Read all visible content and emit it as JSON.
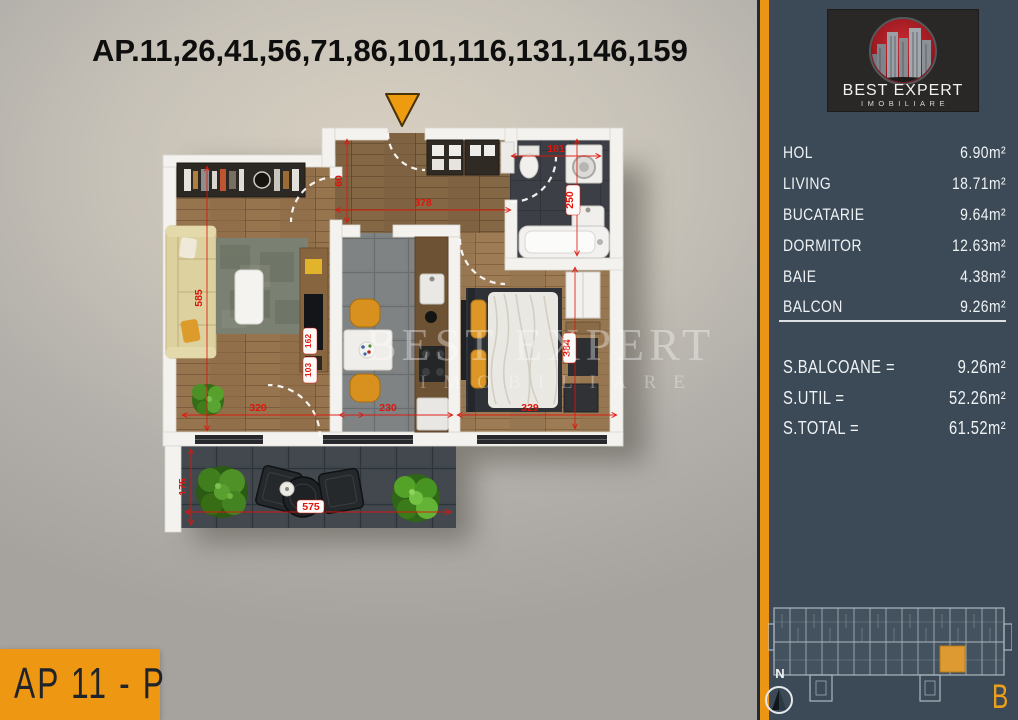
{
  "title": "AP.11,26,41,56,71,86,101,116,131,146,159",
  "apartment": {
    "label": "AP 11 - P"
  },
  "logo": {
    "name": "BEST EXPERT",
    "tagline": "IMOBILIARE"
  },
  "watermark": {
    "line1": "BEST EXPERT",
    "line2": "IMOBILIARE"
  },
  "sidebar": {
    "rooms": [
      {
        "name": "HOL",
        "area": "6.90m²"
      },
      {
        "name": "LIVING",
        "area": "18.71m²"
      },
      {
        "name": "BUCATARIE",
        "area": "9.64m²"
      },
      {
        "name": "DORMITOR",
        "area": "12.63m²"
      },
      {
        "name": "BAIE",
        "area": "4.38m²"
      },
      {
        "name": "BALCON",
        "area": "9.26m²"
      }
    ],
    "totals": [
      {
        "label": "S.BALCOANE =",
        "value": "9.26m²"
      },
      {
        "label": "S.UTIL =",
        "value": "52.26m²"
      },
      {
        "label": "S.TOTAL =",
        "value": "61.52m²"
      }
    ],
    "compass": "N",
    "section": "B"
  },
  "plan": {
    "dims": {
      "living_h": "585",
      "living_w": "320",
      "kitchen_w": "230",
      "bedroom_w": "329",
      "hall_w": "378",
      "hall_d": "60",
      "bath_w": "181",
      "bath_h": "250",
      "bedroom_h": "384",
      "balcony_h": "175",
      "balcony_w": "575",
      "detail_a": "162",
      "detail_b": "103"
    }
  },
  "colors": {
    "accent_orange": "#ec9414",
    "sidebar_bg": "#3c4a57",
    "dim_red": "#e0150b"
  }
}
